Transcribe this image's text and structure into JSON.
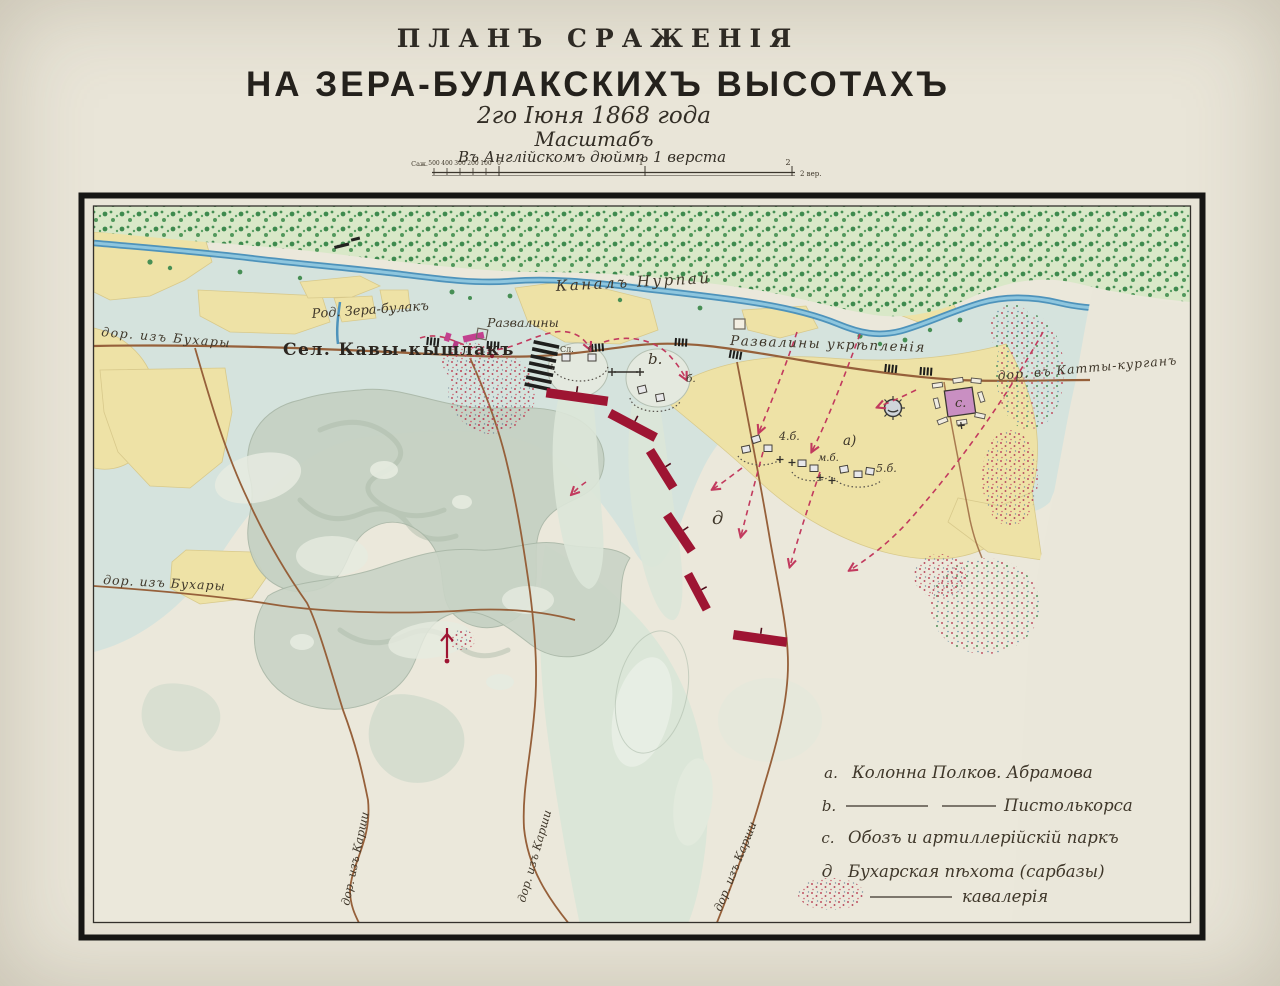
{
  "title": {
    "line1": "ПЛАНЪ СРАЖЕНІЯ",
    "line2": "НА ЗЕРА-БУЛАКСКИХЪ ВЫСОТАХЪ",
    "line3": "2го Іюня 1868 года",
    "line4": "Масштабъ",
    "line5": "Въ Англійскомъ дюймѣ 1 верста"
  },
  "scalebar": {
    "unit_left": "Саж.",
    "left_ticks": [
      "500",
      "400",
      "300",
      "200",
      "100",
      "0"
    ],
    "mid_ticks": [
      "1",
      "2"
    ],
    "right_label": "2 вер."
  },
  "map": {
    "labels": {
      "canal": "Каналъ Нурпай",
      "road_bukhara_top": "дор. изъ Бухары",
      "road_bukhara_mid": "дор. изъ Бухары",
      "spring": "Род. Зера-булакъ",
      "village": "Сел. Кавы-кышлакъ",
      "ruins": "Развалины",
      "ruins_fort": "Развалины укрѣпленія",
      "road_katty": "дор. въ Катты-курганъ",
      "road_karshi_1": "дор. изъ Карши",
      "road_karshi_2": "дор. изъ Карши",
      "road_karshi_3": "дор. изъ Карши"
    },
    "markers": {
      "b": "b.",
      "b_small": "б.",
      "battery4": "4.б.",
      "battery_m": "м.б.",
      "col_a": "а)",
      "battery5": "5.б.",
      "park": "с.",
      "sarbaz": "д",
      "bat_left": "Сл.",
      "bat_right": "б."
    }
  },
  "legend": {
    "items": [
      {
        "key": "a.",
        "label": "Колонна Полков. Абрамова"
      },
      {
        "key": "b.",
        "label": "Пистолькорса"
      },
      {
        "key": "c.",
        "label": "Обозъ и артиллерійскій паркъ"
      },
      {
        "key": "д",
        "label": "Бухарская пѣхота (сарбазы)"
      },
      {
        "key": "",
        "label": "кавалерія"
      }
    ]
  },
  "palette": {
    "paper": "#e9e5d8",
    "ink": "#2e2a24",
    "forest_green": "#3e8a4e",
    "river_blue": "#4e93bb",
    "field_yellow": "#eee2a6",
    "wash_teal": "#d5e3dd",
    "hill_sage": "#bdcbba",
    "road_brown": "#96603a",
    "sarbaz_crimson": "#9e1533",
    "cavalry_red": "#c23a5e",
    "village_pink": "#c2418f",
    "park_violet": "#c98fc2"
  }
}
